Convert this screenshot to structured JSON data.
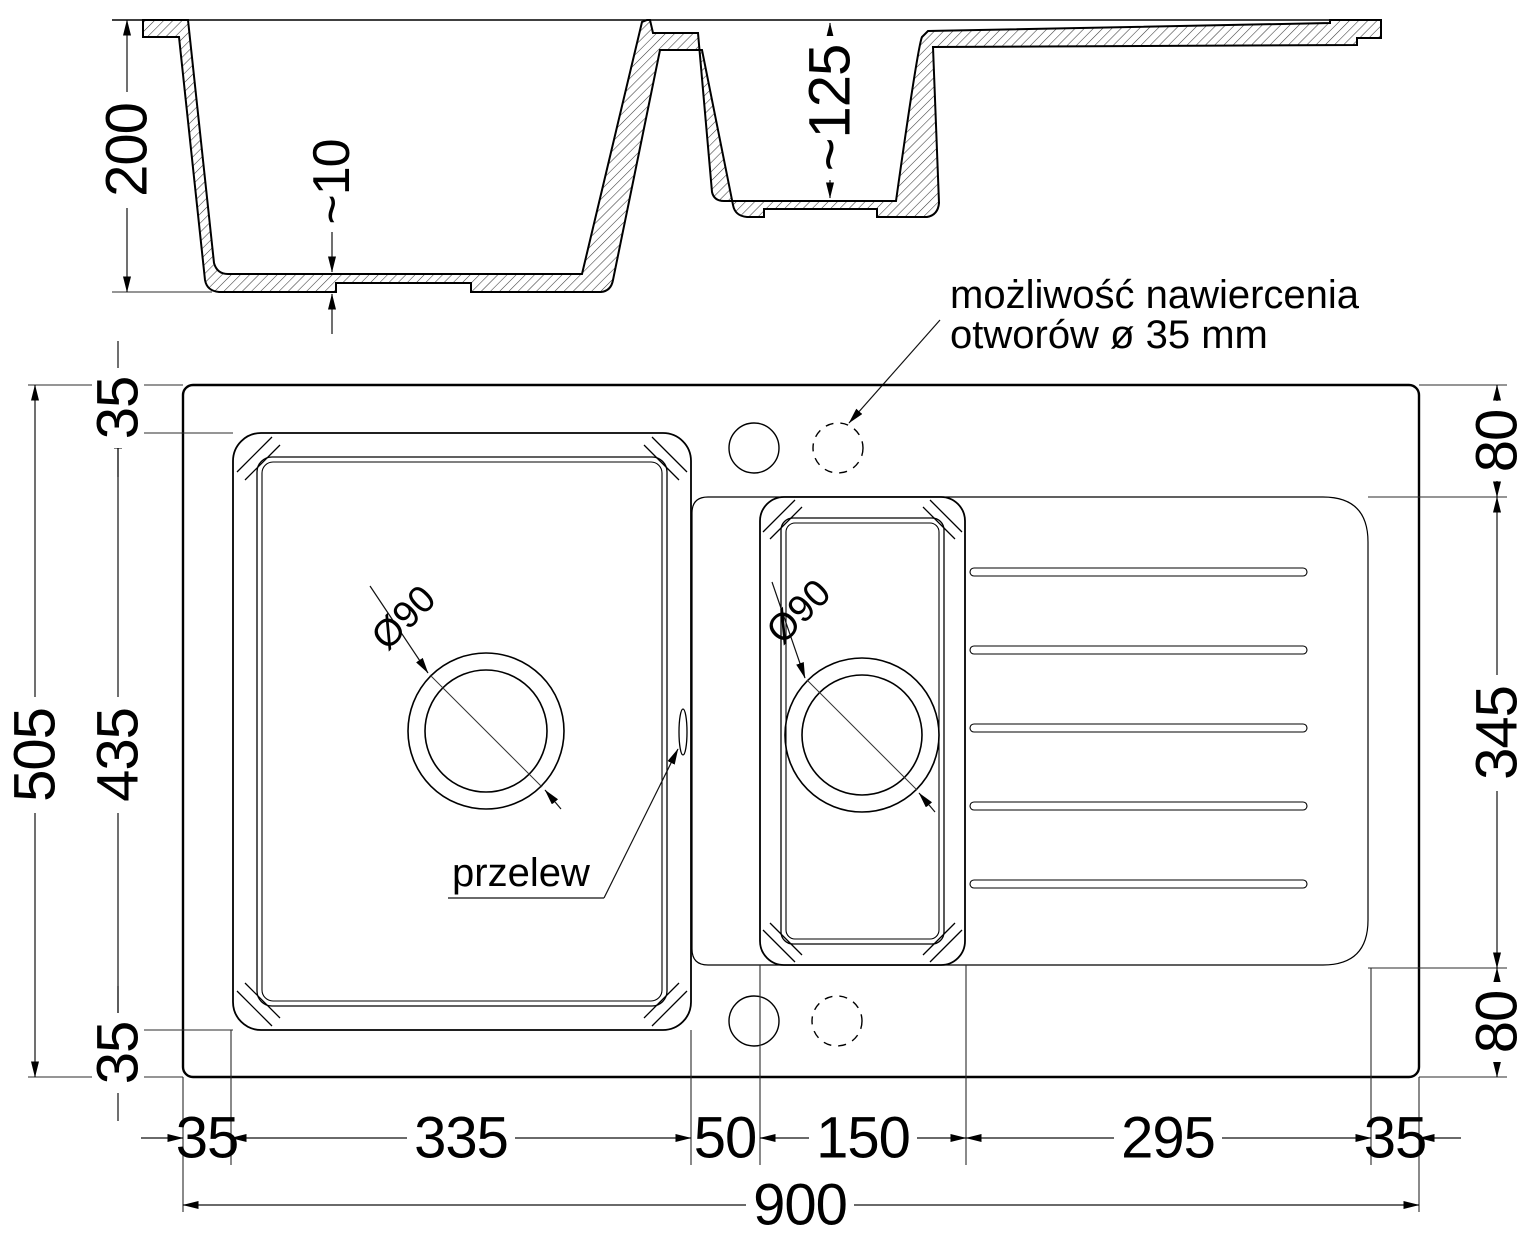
{
  "section": {
    "depth_main": "200",
    "bottom_thickness": "~10",
    "depth_small": "~125",
    "annotation_line1": "możliwość nawiercenia",
    "annotation_line2": "otworów ø 35 mm"
  },
  "plan": {
    "drain_main_label": "Ø90",
    "drain_small_label": "Ø90",
    "overflow_label": "przelew"
  },
  "dims": {
    "left_top_margin": "35",
    "bowl_height": "435",
    "left_bottom_margin": "35",
    "total_height": "505",
    "right_top_margin": "80",
    "drainer_height": "345",
    "right_bottom_margin": "80",
    "bottom_left_margin": "35",
    "bowl_width": "335",
    "divider_gap": "50",
    "small_bowl_width": "150",
    "drainer_width": "295",
    "bottom_right_margin": "35",
    "total_width": "900"
  }
}
